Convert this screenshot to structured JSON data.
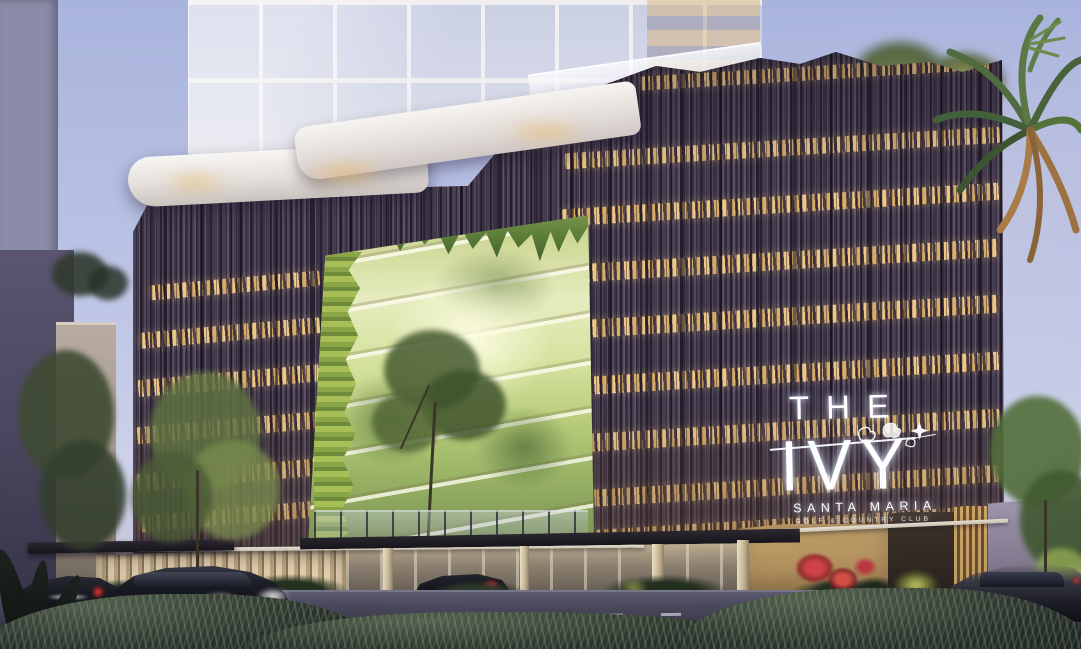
{
  "scene": {
    "description": "Dusk architectural rendering of a condominium: a white glass tower rising from a dark vertical-slat podium with warm lit window bands, a glowing vertical-garden atrium at center, illuminated lobby, street with dark sedans, lush shrubs and palms",
    "time_of_day": "dusk"
  },
  "signage": {
    "the": "THE",
    "ivy": "IVY",
    "santa_maria": "SANTA MARIA",
    "golf_country_club": "GOLF & COUNTRY CLUB"
  },
  "palette": {
    "sky-top": "#a9b4dd",
    "sky-low": "#d7d4e6",
    "slat-dark": "#3a3244",
    "slat-light": "#5c5064",
    "window-glow": "#f0c27c",
    "green-bright": "#e6ecbe",
    "green-mid": "#a3bd5f",
    "green-dark": "#3f5c2a",
    "sign-color": "#fdfeff",
    "tan-wall": "#b8955f",
    "street": "#424150",
    "hedge": "#1b241c",
    "car-dark": "#101117"
  }
}
